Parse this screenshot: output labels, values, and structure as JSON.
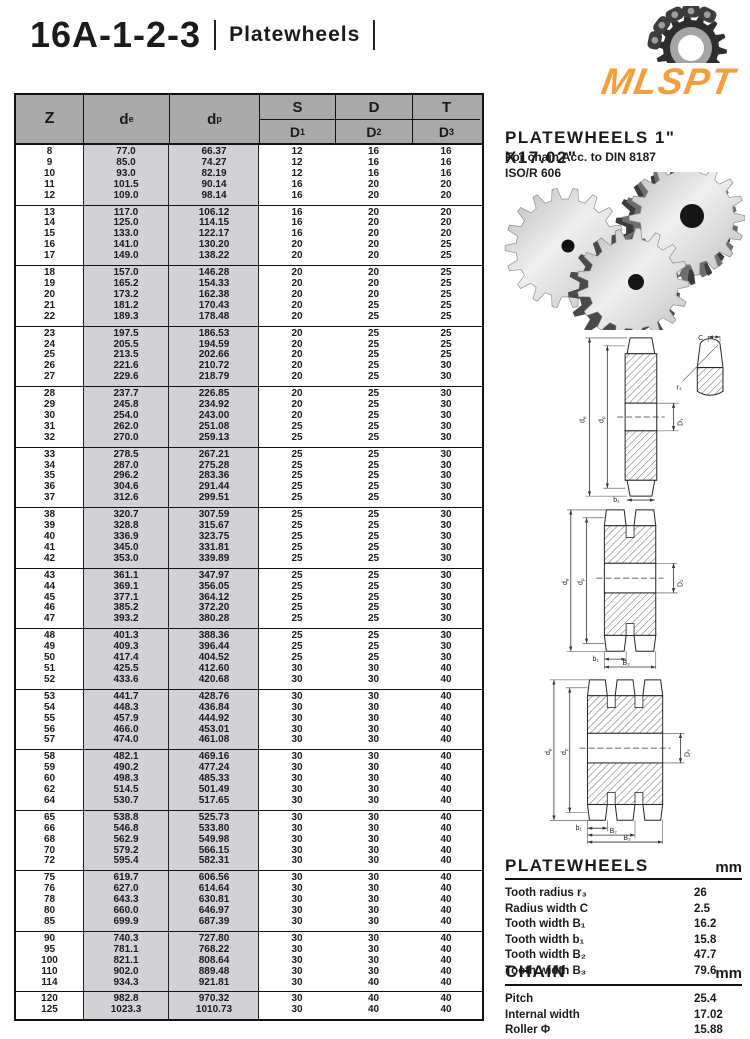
{
  "header": {
    "model": "16A-1-2-3",
    "category": "Platewheels"
  },
  "logo": {
    "text": "MLSPT",
    "color": "#F59E3F"
  },
  "product": {
    "title": "PLATEWHEELS 1\" X17.02\"",
    "line1": "For chain Acc. to DIN 8187",
    "line2": "ISO/R 606"
  },
  "table": {
    "head": {
      "z": "Z",
      "d_base": "d",
      "e_sub": "e",
      "p_sub": "p",
      "s": "S",
      "d": "D",
      "t": "T",
      "dcap1": "D",
      "dcap2": "D",
      "dcap3": "D",
      "s1": "1",
      "s2": "2",
      "s3": "3"
    },
    "groups": [
      [
        [
          "8",
          "77.0",
          "66.37",
          "12",
          "16",
          "16"
        ],
        [
          "9",
          "85.0",
          "74.27",
          "12",
          "16",
          "16"
        ],
        [
          "10",
          "93.0",
          "82.19",
          "12",
          "16",
          "16"
        ],
        [
          "11",
          "101.5",
          "90.14",
          "16",
          "20",
          "20"
        ],
        [
          "12",
          "109.0",
          "98.14",
          "16",
          "20",
          "20"
        ]
      ],
      [
        [
          "13",
          "117.0",
          "106.12",
          "16",
          "20",
          "20"
        ],
        [
          "14",
          "125.0",
          "114.15",
          "16",
          "20",
          "20"
        ],
        [
          "15",
          "133.0",
          "122.17",
          "16",
          "20",
          "20"
        ],
        [
          "16",
          "141.0",
          "130.20",
          "20",
          "20",
          "25"
        ],
        [
          "17",
          "149.0",
          "138.22",
          "20",
          "20",
          "25"
        ]
      ],
      [
        [
          "18",
          "157.0",
          "146.28",
          "20",
          "20",
          "25"
        ],
        [
          "19",
          "165.2",
          "154.33",
          "20",
          "20",
          "25"
        ],
        [
          "20",
          "173.2",
          "162.38",
          "20",
          "20",
          "25"
        ],
        [
          "21",
          "181.2",
          "170.43",
          "20",
          "25",
          "25"
        ],
        [
          "22",
          "189.3",
          "178.48",
          "20",
          "25",
          "25"
        ]
      ],
      [
        [
          "23",
          "197.5",
          "186.53",
          "20",
          "25",
          "25"
        ],
        [
          "24",
          "205.5",
          "194.59",
          "20",
          "25",
          "25"
        ],
        [
          "25",
          "213.5",
          "202.66",
          "20",
          "25",
          "25"
        ],
        [
          "26",
          "221.6",
          "210.72",
          "20",
          "25",
          "30"
        ],
        [
          "27",
          "229.6",
          "218.79",
          "20",
          "25",
          "30"
        ]
      ],
      [
        [
          "28",
          "237.7",
          "226.85",
          "20",
          "25",
          "30"
        ],
        [
          "29",
          "245.8",
          "234.92",
          "20",
          "25",
          "30"
        ],
        [
          "30",
          "254.0",
          "243.00",
          "20",
          "25",
          "30"
        ],
        [
          "31",
          "262.0",
          "251.08",
          "25",
          "25",
          "30"
        ],
        [
          "32",
          "270.0",
          "259.13",
          "25",
          "25",
          "30"
        ]
      ],
      [
        [
          "33",
          "278.5",
          "267.21",
          "25",
          "25",
          "30"
        ],
        [
          "34",
          "287.0",
          "275.28",
          "25",
          "25",
          "30"
        ],
        [
          "35",
          "296.2",
          "283.36",
          "25",
          "25",
          "30"
        ],
        [
          "36",
          "304.6",
          "291.44",
          "25",
          "25",
          "30"
        ],
        [
          "37",
          "312.6",
          "299.51",
          "25",
          "25",
          "30"
        ]
      ],
      [
        [
          "38",
          "320.7",
          "307.59",
          "25",
          "25",
          "30"
        ],
        [
          "39",
          "328.8",
          "315.67",
          "25",
          "25",
          "30"
        ],
        [
          "40",
          "336.9",
          "323.75",
          "25",
          "25",
          "30"
        ],
        [
          "41",
          "345.0",
          "331.81",
          "25",
          "25",
          "30"
        ],
        [
          "42",
          "353.0",
          "339.89",
          "25",
          "25",
          "30"
        ]
      ],
      [
        [
          "43",
          "361.1",
          "347.97",
          "25",
          "25",
          "30"
        ],
        [
          "44",
          "369.1",
          "356.05",
          "25",
          "25",
          "30"
        ],
        [
          "45",
          "377.1",
          "364.12",
          "25",
          "25",
          "30"
        ],
        [
          "46",
          "385.2",
          "372.20",
          "25",
          "25",
          "30"
        ],
        [
          "47",
          "393.2",
          "380.28",
          "25",
          "25",
          "30"
        ]
      ],
      [
        [
          "48",
          "401.3",
          "388.36",
          "25",
          "25",
          "30"
        ],
        [
          "49",
          "409.3",
          "396.44",
          "25",
          "25",
          "30"
        ],
        [
          "50",
          "417.4",
          "404.52",
          "25",
          "25",
          "30"
        ],
        [
          "51",
          "425.5",
          "412.60",
          "30",
          "30",
          "40"
        ],
        [
          "52",
          "433.6",
          "420.68",
          "30",
          "30",
          "40"
        ]
      ],
      [
        [
          "53",
          "441.7",
          "428.76",
          "30",
          "30",
          "40"
        ],
        [
          "54",
          "448.3",
          "436.84",
          "30",
          "30",
          "40"
        ],
        [
          "55",
          "457.9",
          "444.92",
          "30",
          "30",
          "40"
        ],
        [
          "56",
          "466.0",
          "453.01",
          "30",
          "30",
          "40"
        ],
        [
          "57",
          "474.0",
          "461.08",
          "30",
          "30",
          "40"
        ]
      ],
      [
        [
          "58",
          "482.1",
          "469.16",
          "30",
          "30",
          "40"
        ],
        [
          "59",
          "490.2",
          "477.24",
          "30",
          "30",
          "40"
        ],
        [
          "60",
          "498.3",
          "485.33",
          "30",
          "30",
          "40"
        ],
        [
          "62",
          "514.5",
          "501.49",
          "30",
          "30",
          "40"
        ],
        [
          "64",
          "530.7",
          "517.65",
          "30",
          "30",
          "40"
        ]
      ],
      [
        [
          "65",
          "538.8",
          "525.73",
          "30",
          "30",
          "40"
        ],
        [
          "66",
          "546.8",
          "533.80",
          "30",
          "30",
          "40"
        ],
        [
          "68",
          "562.9",
          "549.98",
          "30",
          "30",
          "40"
        ],
        [
          "70",
          "579.2",
          "566.15",
          "30",
          "30",
          "40"
        ],
        [
          "72",
          "595.4",
          "582.31",
          "30",
          "30",
          "40"
        ]
      ],
      [
        [
          "75",
          "619.7",
          "606.56",
          "30",
          "30",
          "40"
        ],
        [
          "76",
          "627.0",
          "614.64",
          "30",
          "30",
          "40"
        ],
        [
          "78",
          "643.3",
          "630.81",
          "30",
          "30",
          "40"
        ],
        [
          "80",
          "660.0",
          "646.97",
          "30",
          "30",
          "40"
        ],
        [
          "85",
          "699.9",
          "687.39",
          "30",
          "30",
          "40"
        ]
      ],
      [
        [
          "90",
          "740.3",
          "727.80",
          "30",
          "30",
          "40"
        ],
        [
          "95",
          "781.1",
          "768.22",
          "30",
          "30",
          "40"
        ],
        [
          "100",
          "821.1",
          "808.64",
          "30",
          "30",
          "40"
        ],
        [
          "110",
          "902.0",
          "889.48",
          "30",
          "30",
          "40"
        ],
        [
          "114",
          "934.3",
          "921.81",
          "30",
          "40",
          "40"
        ]
      ],
      [
        [
          "120",
          "982.8",
          "970.32",
          "30",
          "40",
          "40"
        ],
        [
          "125",
          "1023.3",
          "1010.73",
          "30",
          "40",
          "40"
        ]
      ]
    ]
  },
  "diagrams": {
    "d_base": "d",
    "e_sub": "e",
    "p_sub": "p",
    "d1": "D₁",
    "d2": "D₂",
    "d3": "D₃",
    "b1": "b₁",
    "b2": "B₂",
    "b3": "B₃",
    "c": "C",
    "r3": "r₃"
  },
  "specs": {
    "platewheels": {
      "title": "PLATEWHEELS",
      "unit": "mm",
      "rows": [
        [
          "Tooth radius r₃",
          "26"
        ],
        [
          "Radius width C",
          "2.5"
        ],
        [
          "Tooth width B₁",
          "16.2"
        ],
        [
          "Tooth width b₁",
          "15.8"
        ],
        [
          "Tooth width B₂",
          "47.7"
        ],
        [
          "Tooth width B₃",
          "79.6"
        ]
      ]
    },
    "chain": {
      "title": "CHAIN",
      "unit": "mm",
      "rows": [
        [
          "Pitch",
          "25.4"
        ],
        [
          "Internal width",
          "17.02"
        ],
        [
          "Roller Φ",
          "15.88"
        ]
      ]
    }
  }
}
